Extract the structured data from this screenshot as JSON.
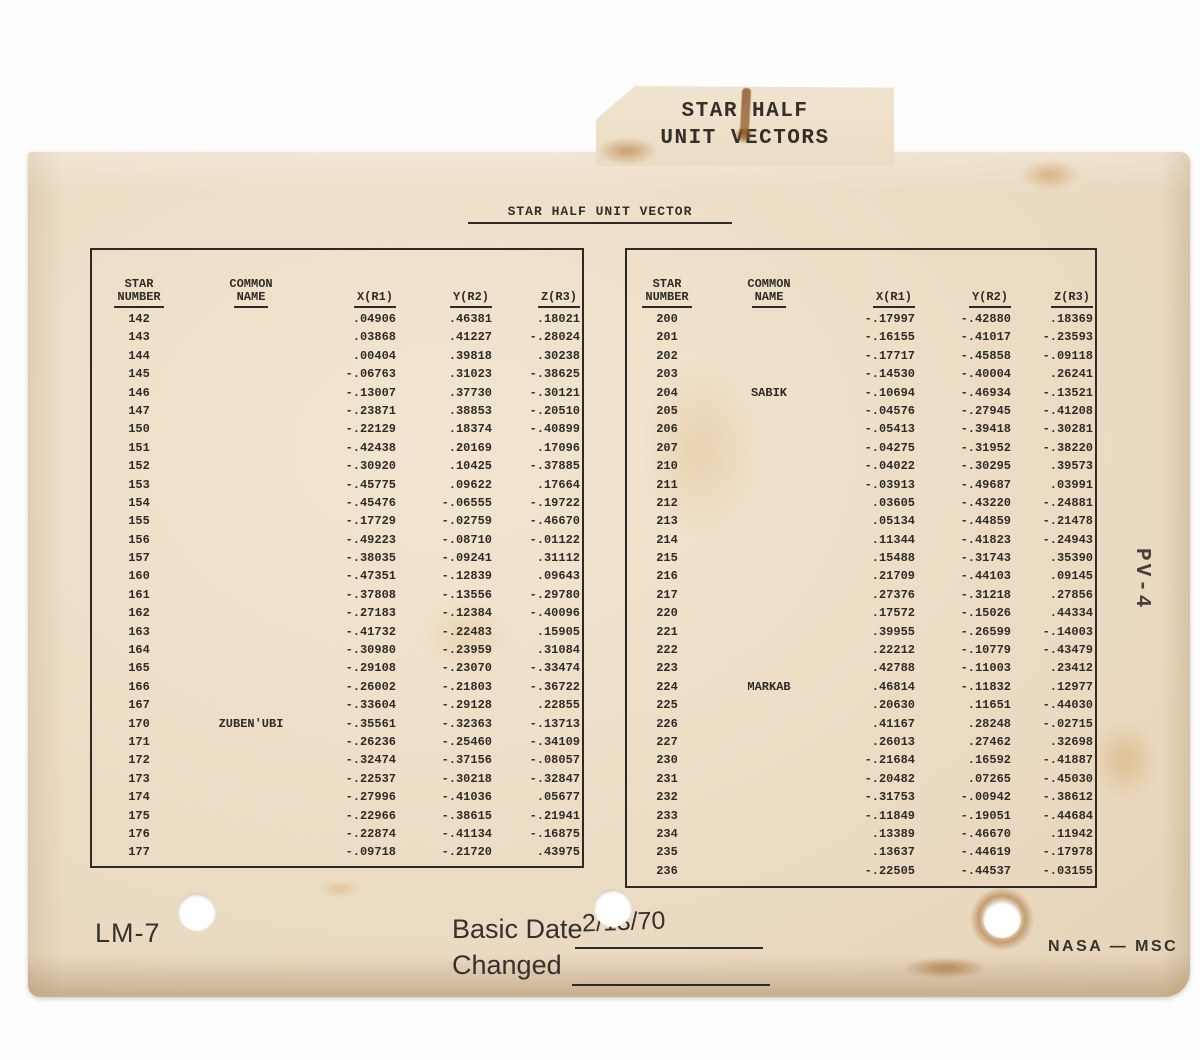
{
  "card": {
    "tab_label_line1": "STAR HALF",
    "tab_label_line2": "UNIT VECTORS",
    "title": "STAR HALF UNIT VECTOR",
    "side_label": "PV-4"
  },
  "table_headers": {
    "star_number_l1": "STAR",
    "star_number_l2": "NUMBER",
    "common_name_l1": "COMMON",
    "common_name_l2": "NAME",
    "x": "X(R1)",
    "y": "Y(R2)",
    "z": "Z(R3)"
  },
  "left_table": {
    "rows": [
      {
        "num": "142",
        "name": "",
        "x": ".04906",
        "y": ".46381",
        "z": ".18021"
      },
      {
        "num": "143",
        "name": "",
        "x": ".03868",
        "y": ".41227",
        "z": "-.28024"
      },
      {
        "num": "144",
        "name": "",
        "x": ".00404",
        "y": ".39818",
        "z": ".30238"
      },
      {
        "num": "145",
        "name": "",
        "x": "-.06763",
        "y": ".31023",
        "z": "-.38625"
      },
      {
        "num": "146",
        "name": "",
        "x": "-.13007",
        "y": ".37730",
        "z": "-.30121"
      },
      {
        "num": "147",
        "name": "",
        "x": "-.23871",
        "y": ".38853",
        "z": "-.20510"
      },
      {
        "num": "150",
        "name": "",
        "x": "-.22129",
        "y": ".18374",
        "z": "-.40899"
      },
      {
        "num": "151",
        "name": "",
        "x": "-.42438",
        "y": ".20169",
        "z": ".17096"
      },
      {
        "num": "152",
        "name": "",
        "x": "-.30920",
        "y": ".10425",
        "z": "-.37885"
      },
      {
        "num": "153",
        "name": "",
        "x": "-.45775",
        "y": ".09622",
        "z": ".17664"
      },
      {
        "num": "154",
        "name": "",
        "x": "-.45476",
        "y": "-.06555",
        "z": "-.19722"
      },
      {
        "num": "155",
        "name": "",
        "x": "-.17729",
        "y": "-.02759",
        "z": "-.46670"
      },
      {
        "num": "156",
        "name": "",
        "x": "-.49223",
        "y": "-.08710",
        "z": "-.01122"
      },
      {
        "num": "157",
        "name": "",
        "x": "-.38035",
        "y": "-.09241",
        "z": ".31112"
      },
      {
        "num": "160",
        "name": "",
        "x": "-.47351",
        "y": "-.12839",
        "z": ".09643"
      },
      {
        "num": "161",
        "name": "",
        "x": "-.37808",
        "y": "-.13556",
        "z": "-.29780"
      },
      {
        "num": "162",
        "name": "",
        "x": "-.27183",
        "y": "-.12384",
        "z": "-.40096"
      },
      {
        "num": "163",
        "name": "",
        "x": "-.41732",
        "y": "-.22483",
        "z": ".15905"
      },
      {
        "num": "164",
        "name": "",
        "x": "-.30980",
        "y": "-.23959",
        "z": ".31084"
      },
      {
        "num": "165",
        "name": "",
        "x": "-.29108",
        "y": "-.23070",
        "z": "-.33474"
      },
      {
        "num": "166",
        "name": "",
        "x": "-.26002",
        "y": "-.21803",
        "z": "-.36722"
      },
      {
        "num": "167",
        "name": "",
        "x": "-.33604",
        "y": "-.29128",
        "z": ".22855"
      },
      {
        "num": "170",
        "name": "ZUBEN'UBI",
        "x": "-.35561",
        "y": "-.32363",
        "z": "-.13713"
      },
      {
        "num": "171",
        "name": "",
        "x": "-.26236",
        "y": "-.25460",
        "z": "-.34109"
      },
      {
        "num": "172",
        "name": "",
        "x": "-.32474",
        "y": "-.37156",
        "z": "-.08057"
      },
      {
        "num": "173",
        "name": "",
        "x": "-.22537",
        "y": "-.30218",
        "z": "-.32847"
      },
      {
        "num": "174",
        "name": "",
        "x": "-.27996",
        "y": "-.41036",
        "z": ".05677"
      },
      {
        "num": "175",
        "name": "",
        "x": "-.22966",
        "y": "-.38615",
        "z": "-.21941"
      },
      {
        "num": "176",
        "name": "",
        "x": "-.22874",
        "y": "-.41134",
        "z": "-.16875"
      },
      {
        "num": "177",
        "name": "",
        "x": "-.09718",
        "y": "-.21720",
        "z": ".43975"
      }
    ]
  },
  "right_table": {
    "rows": [
      {
        "num": "200",
        "name": "",
        "x": "-.17997",
        "y": "-.42880",
        "z": ".18369"
      },
      {
        "num": "201",
        "name": "",
        "x": "-.16155",
        "y": "-.41017",
        "z": "-.23593"
      },
      {
        "num": "202",
        "name": "",
        "x": "-.17717",
        "y": "-.45858",
        "z": "-.09118"
      },
      {
        "num": "203",
        "name": "",
        "x": "-.14530",
        "y": "-.40004",
        "z": ".26241"
      },
      {
        "num": "204",
        "name": "SABIK",
        "x": "-.10694",
        "y": "-.46934",
        "z": "-.13521"
      },
      {
        "num": "205",
        "name": "",
        "x": "-.04576",
        "y": "-.27945",
        "z": "-.41208"
      },
      {
        "num": "206",
        "name": "",
        "x": "-.05413",
        "y": "-.39418",
        "z": "-.30281"
      },
      {
        "num": "207",
        "name": "",
        "x": "-.04275",
        "y": "-.31952",
        "z": "-.38220"
      },
      {
        "num": "210",
        "name": "",
        "x": "-.04022",
        "y": "-.30295",
        "z": ".39573"
      },
      {
        "num": "211",
        "name": "",
        "x": "-.03913",
        "y": "-.49687",
        "z": ".03991"
      },
      {
        "num": "212",
        "name": "",
        "x": ".03605",
        "y": "-.43220",
        "z": "-.24881"
      },
      {
        "num": "213",
        "name": "",
        "x": ".05134",
        "y": "-.44859",
        "z": "-.21478"
      },
      {
        "num": "214",
        "name": "",
        "x": ".11344",
        "y": "-.41823",
        "z": "-.24943"
      },
      {
        "num": "215",
        "name": "",
        "x": ".15488",
        "y": "-.31743",
        "z": ".35390"
      },
      {
        "num": "216",
        "name": "",
        "x": ".21709",
        "y": "-.44103",
        "z": ".09145"
      },
      {
        "num": "217",
        "name": "",
        "x": ".27376",
        "y": "-.31218",
        "z": ".27856"
      },
      {
        "num": "220",
        "name": "",
        "x": ".17572",
        "y": "-.15026",
        "z": ".44334"
      },
      {
        "num": "221",
        "name": "",
        "x": ".39955",
        "y": "-.26599",
        "z": "-.14003"
      },
      {
        "num": "222",
        "name": "",
        "x": ".22212",
        "y": "-.10779",
        "z": "-.43479"
      },
      {
        "num": "223",
        "name": "",
        "x": ".42788",
        "y": "-.11003",
        "z": ".23412"
      },
      {
        "num": "224",
        "name": "MARKAB",
        "x": ".46814",
        "y": "-.11832",
        "z": ".12977"
      },
      {
        "num": "225",
        "name": "",
        "x": ".20630",
        "y": ".11651",
        "z": "-.44030"
      },
      {
        "num": "226",
        "name": "",
        "x": ".41167",
        "y": ".28248",
        "z": "-.02715"
      },
      {
        "num": "227",
        "name": "",
        "x": ".26013",
        "y": ".27462",
        "z": ".32698"
      },
      {
        "num": "230",
        "name": "",
        "x": "-.21684",
        "y": ".16592",
        "z": "-.41887"
      },
      {
        "num": "231",
        "name": "",
        "x": "-.20482",
        "y": ".07265",
        "z": "-.45030"
      },
      {
        "num": "232",
        "name": "",
        "x": "-.31753",
        "y": "-.00942",
        "z": "-.38612"
      },
      {
        "num": "233",
        "name": "",
        "x": "-.11849",
        "y": "-.19051",
        "z": "-.44684"
      },
      {
        "num": "234",
        "name": "",
        "x": ".13389",
        "y": "-.46670",
        "z": ".11942"
      },
      {
        "num": "235",
        "name": "",
        "x": ".13637",
        "y": "-.44619",
        "z": "-.17978"
      },
      {
        "num": "236",
        "name": "",
        "x": "-.22505",
        "y": "-.44537",
        "z": "-.03155"
      }
    ]
  },
  "footer": {
    "program_label": "LM-7",
    "basic_date_label": "Basic Date",
    "basic_date_value": "2/13/70",
    "changed_label": "Changed",
    "org_label": "NASA — MSC"
  },
  "colors": {
    "card": "#ecdcc4",
    "text": "#2e2b26",
    "background": "#ffffff"
  }
}
